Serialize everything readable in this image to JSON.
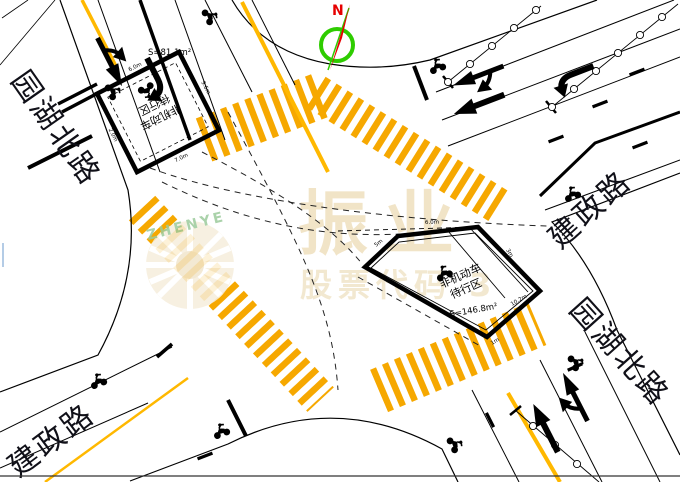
{
  "roads": {
    "yuanhu_north_top": "园湖北路",
    "yuanhu_north_bottom": "园湖北路",
    "jianzheng_left": "建政路",
    "jianzheng_right": "建政路"
  },
  "compass": {
    "north": "N"
  },
  "waiting_areas": {
    "north": {
      "line1": "非机动车",
      "line2": "待行区",
      "area": "S=81.1m²",
      "dims": [
        "6.0m",
        "9.6m",
        "7.0m",
        "2.0m"
      ]
    },
    "east": {
      "line1": "非机动车",
      "line2": "待行区",
      "area": "S=146.8m²",
      "dims": [
        "6.0m",
        "5m",
        "3m",
        "10.2m",
        "1m"
      ]
    }
  },
  "watermark": {
    "brand": "振业",
    "stock": "股票代码 3",
    "logo": "ZHENYE"
  },
  "colors": {
    "stripe_yellow": "#F6A800",
    "line_yellow": "#FFB800",
    "line_black": "#000000",
    "compass_green": "#2ECC00",
    "compass_red": "#E60000",
    "watermark_tan": "#EFE0BE",
    "watermark_green": "#9CCB9C"
  }
}
